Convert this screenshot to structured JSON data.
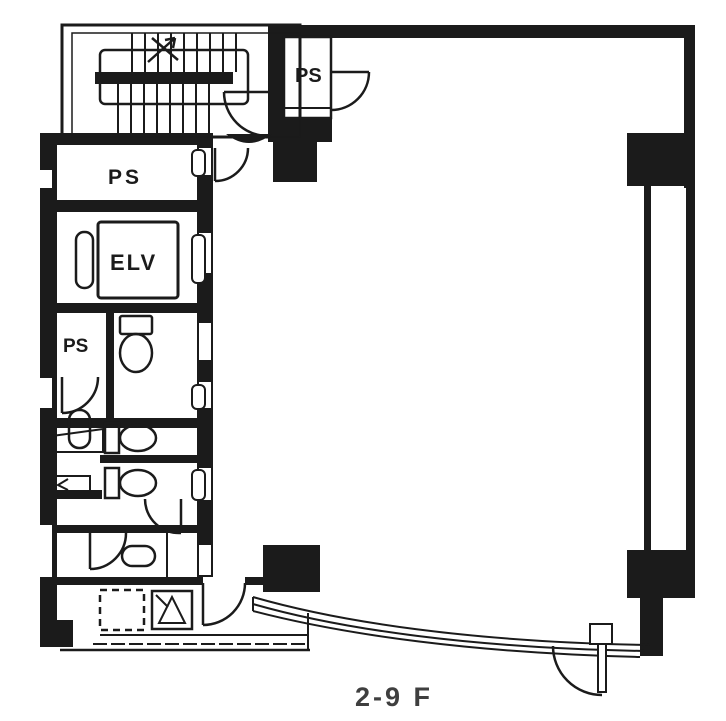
{
  "floorplan": {
    "floor_label": "2-9 F",
    "rooms": {
      "ps_top_right": "PS",
      "ps_upper_left": "PS",
      "ps_lower_left": "PS",
      "elevator": "ELV"
    },
    "colors": {
      "ink": "#1b1b1b",
      "floor_label_text": "#3f3f3f",
      "background": "#ffffff"
    }
  }
}
